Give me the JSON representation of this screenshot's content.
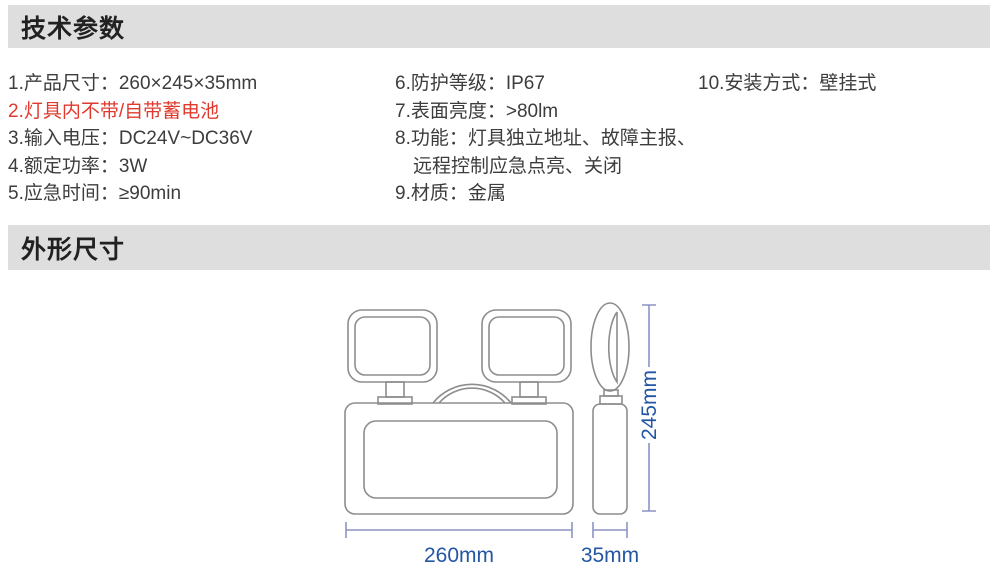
{
  "sections": {
    "tech_params": {
      "title": "技术参数",
      "columns": [
        {
          "items": [
            {
              "text": "1.产品尺寸：260×245×35mm"
            },
            {
              "text": "2.灯具内不带/自带蓄电池",
              "highlight": "red"
            },
            {
              "text": "3.输入电压：DC24V~DC36V"
            },
            {
              "text": "4.额定功率：3W"
            },
            {
              "text": "5.应急时间：≥90min"
            }
          ]
        },
        {
          "items": [
            {
              "text": "6.防护等级：IP67"
            },
            {
              "text": "7.表面亮度：>80lm"
            },
            {
              "text": "8.功能：灯具独立地址、故障主报、"
            },
            {
              "text": "远程控制应急点亮、关闭",
              "continuation": true
            },
            {
              "text": "9.材质：金属"
            }
          ]
        },
        {
          "items": [
            {
              "text": "10.安装方式：壁挂式"
            }
          ]
        }
      ]
    },
    "outline": {
      "title": "外形尺寸",
      "dimension_labels": {
        "width": "260mm",
        "depth": "35mm",
        "height": "245mm"
      }
    }
  },
  "colors": {
    "section_bar_bg": "#dfdede",
    "heading_text": "#212121",
    "body_text": "#3d3d3d",
    "highlight_red": "#e03a2f",
    "dimension_text_blue": "#2456a4",
    "dimension_line_blue": "#8a94c4",
    "drawing_outline_gray": "#8d8d8d"
  }
}
